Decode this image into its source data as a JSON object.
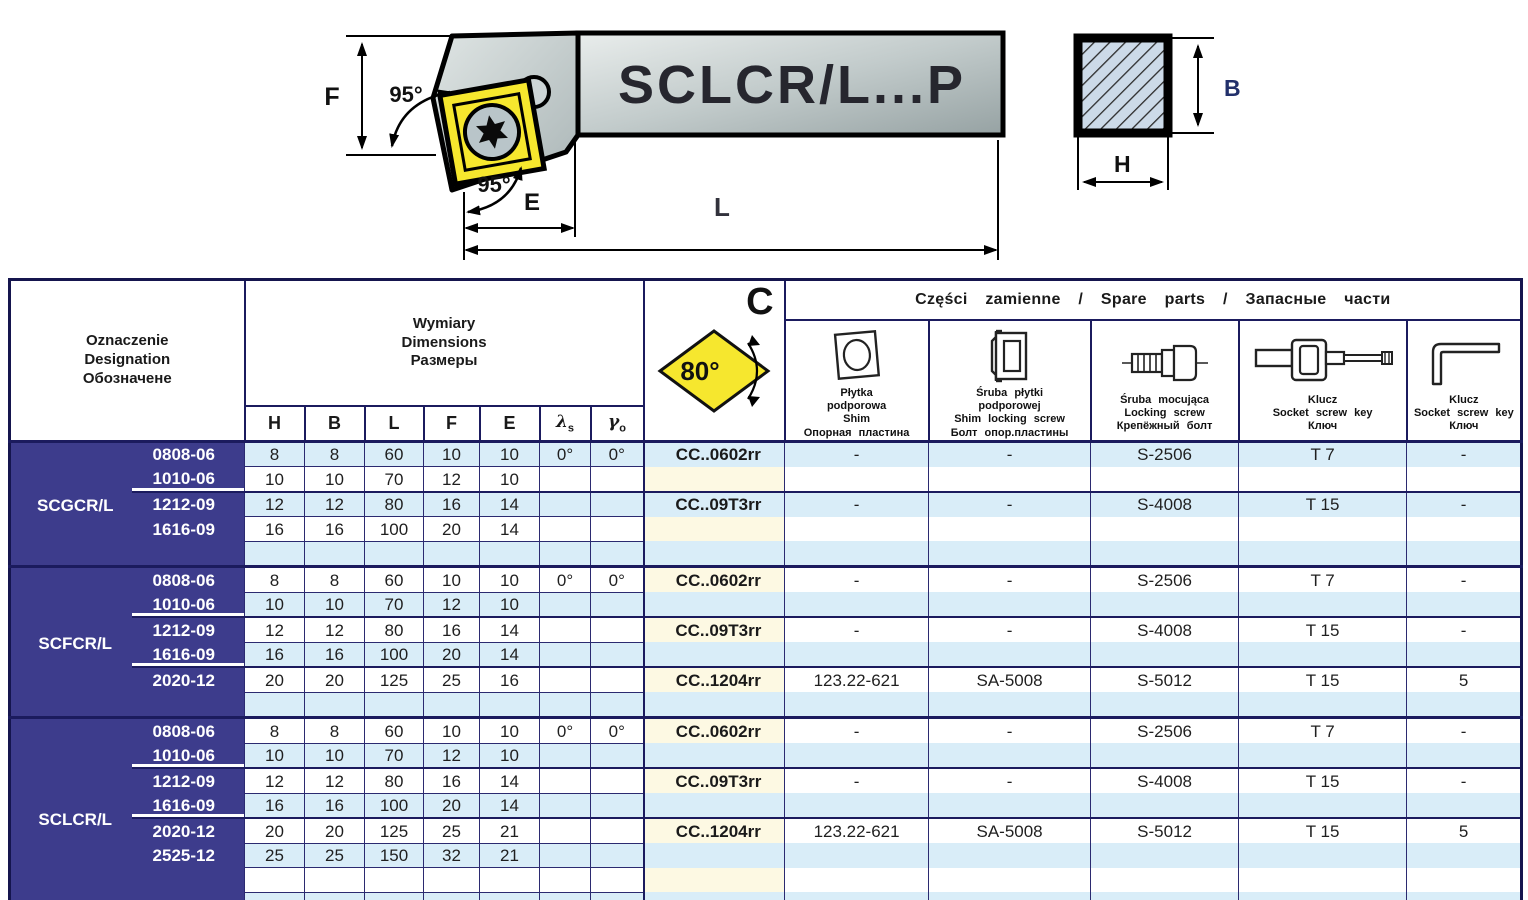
{
  "colors": {
    "navy": "#3d3c8c",
    "row_blue": "#d9edf8",
    "row_cream": "#fdf9e3",
    "insert_yellow": "#f6e72e",
    "grid_line": "#1b1b5e",
    "section_fill": "#ccdae8"
  },
  "drawing": {
    "model": "SCLCR/L...P",
    "angles": {
      "top": "95°",
      "side": "95°"
    },
    "labels": {
      "F": "F",
      "E": "E",
      "L": "L",
      "B": "B",
      "H": "H"
    }
  },
  "header": {
    "designation_lines": [
      "Oznaczenie",
      "Designation",
      "Обозначене"
    ],
    "dimensions_lines": [
      "Wymiary",
      "Dimensions",
      "Размеры"
    ],
    "dim_cols": {
      "H": "H",
      "B": "B",
      "L": "L",
      "F": "F",
      "E": "E"
    },
    "lambda": "λ",
    "lambda_sub": "s",
    "gamma": "γ",
    "gamma_sub": "o",
    "insert": {
      "letter": "C",
      "angle": "80°"
    },
    "spare_title": "Części zamienne / Spare parts / Запасные части",
    "spare_parts": [
      {
        "icon": "shim-icon",
        "lines": [
          "Płytka",
          "podporowa",
          "Shim",
          "Опорная пластина"
        ]
      },
      {
        "icon": "shim-locking-screw-icon",
        "lines": [
          "Śruba płytki",
          "podporowej",
          "Shim locking screw",
          "Болт опор.пластины"
        ]
      },
      {
        "icon": "locking-screw-icon",
        "lines": [
          "Śruba mocująca",
          "Locking screw",
          "Крепёжный болт"
        ]
      },
      {
        "icon": "socket-screw-key-icon",
        "lines": [
          "Klucz",
          "Socket screw key",
          "Ключ"
        ]
      },
      {
        "icon": "hex-key-icon",
        "lines": [
          "Klucz",
          "Socket screw key",
          "Ключ"
        ]
      }
    ]
  },
  "table": {
    "groups": [
      {
        "designation": "SCGCR/L",
        "rows": [
          {
            "size": "0808-06",
            "H": "8",
            "B": "8",
            "L": "60",
            "F": "10",
            "E": "10",
            "ls": "0°",
            "go": "0°",
            "insert": "CC..0602rr",
            "shim": "-",
            "shim_screw": "-",
            "lock_screw": "S-2506",
            "key1": "T 7",
            "key2": "-"
          },
          {
            "size": "1010-06",
            "H": "10",
            "B": "10",
            "L": "70",
            "F": "12",
            "E": "10",
            "u": true
          },
          {
            "size": "1212-09",
            "H": "12",
            "B": "12",
            "L": "80",
            "F": "16",
            "E": "14",
            "sub": true,
            "insert": "CC..09T3rr",
            "shim": "-",
            "shim_screw": "-",
            "lock_screw": "S-4008",
            "key1": "T 15",
            "key2": "-"
          },
          {
            "size": "1616-09",
            "H": "16",
            "B": "16",
            "L": "100",
            "F": "20",
            "E": "14"
          },
          {}
        ]
      },
      {
        "designation": "SCFCR/L",
        "rows": [
          {
            "size": "0808-06",
            "H": "8",
            "B": "8",
            "L": "60",
            "F": "10",
            "E": "10",
            "ls": "0°",
            "go": "0°",
            "insert": "CC..0602rr",
            "shim": "-",
            "shim_screw": "-",
            "lock_screw": "S-2506",
            "key1": "T 7",
            "key2": "-"
          },
          {
            "size": "1010-06",
            "H": "10",
            "B": "10",
            "L": "70",
            "F": "12",
            "E": "10",
            "u": true
          },
          {
            "size": "1212-09",
            "H": "12",
            "B": "12",
            "L": "80",
            "F": "16",
            "E": "14",
            "sub": true,
            "insert": "CC..09T3rr",
            "shim": "-",
            "shim_screw": "-",
            "lock_screw": "S-4008",
            "key1": "T 15",
            "key2": "-"
          },
          {
            "size": "1616-09",
            "H": "16",
            "B": "16",
            "L": "100",
            "F": "20",
            "E": "14",
            "u": true
          },
          {
            "size": "2020-12",
            "H": "20",
            "B": "20",
            "L": "125",
            "F": "25",
            "E": "16",
            "sub": true,
            "insert": "CC..1204rr",
            "shim": "123.22-621",
            "shim_screw": "SA-5008",
            "lock_screw": "S-5012",
            "key1": "T 15",
            "key2": "5"
          },
          {}
        ]
      },
      {
        "designation": "SCLCR/L",
        "rows": [
          {
            "size": "0808-06",
            "H": "8",
            "B": "8",
            "L": "60",
            "F": "10",
            "E": "10",
            "ls": "0°",
            "go": "0°",
            "insert": "CC..0602rr",
            "shim": "-",
            "shim_screw": "-",
            "lock_screw": "S-2506",
            "key1": "T 7",
            "key2": "-"
          },
          {
            "size": "1010-06",
            "H": "10",
            "B": "10",
            "L": "70",
            "F": "12",
            "E": "10",
            "u": true
          },
          {
            "size": "1212-09",
            "H": "12",
            "B": "12",
            "L": "80",
            "F": "16",
            "E": "14",
            "sub": true,
            "insert": "CC..09T3rr",
            "shim": "-",
            "shim_screw": "-",
            "lock_screw": "S-4008",
            "key1": "T 15",
            "key2": "-"
          },
          {
            "size": "1616-09",
            "H": "16",
            "B": "16",
            "L": "100",
            "F": "20",
            "E": "14",
            "u": true
          },
          {
            "size": "2020-12",
            "H": "20",
            "B": "20",
            "L": "125",
            "F": "25",
            "E": "21",
            "sub": true,
            "insert": "CC..1204rr",
            "shim": "123.22-621",
            "shim_screw": "SA-5008",
            "lock_screw": "S-5012",
            "key1": "T 15",
            "key2": "5"
          },
          {
            "size": "2525-12",
            "H": "25",
            "B": "25",
            "L": "150",
            "F": "32",
            "E": "21"
          },
          {},
          {}
        ]
      }
    ]
  }
}
